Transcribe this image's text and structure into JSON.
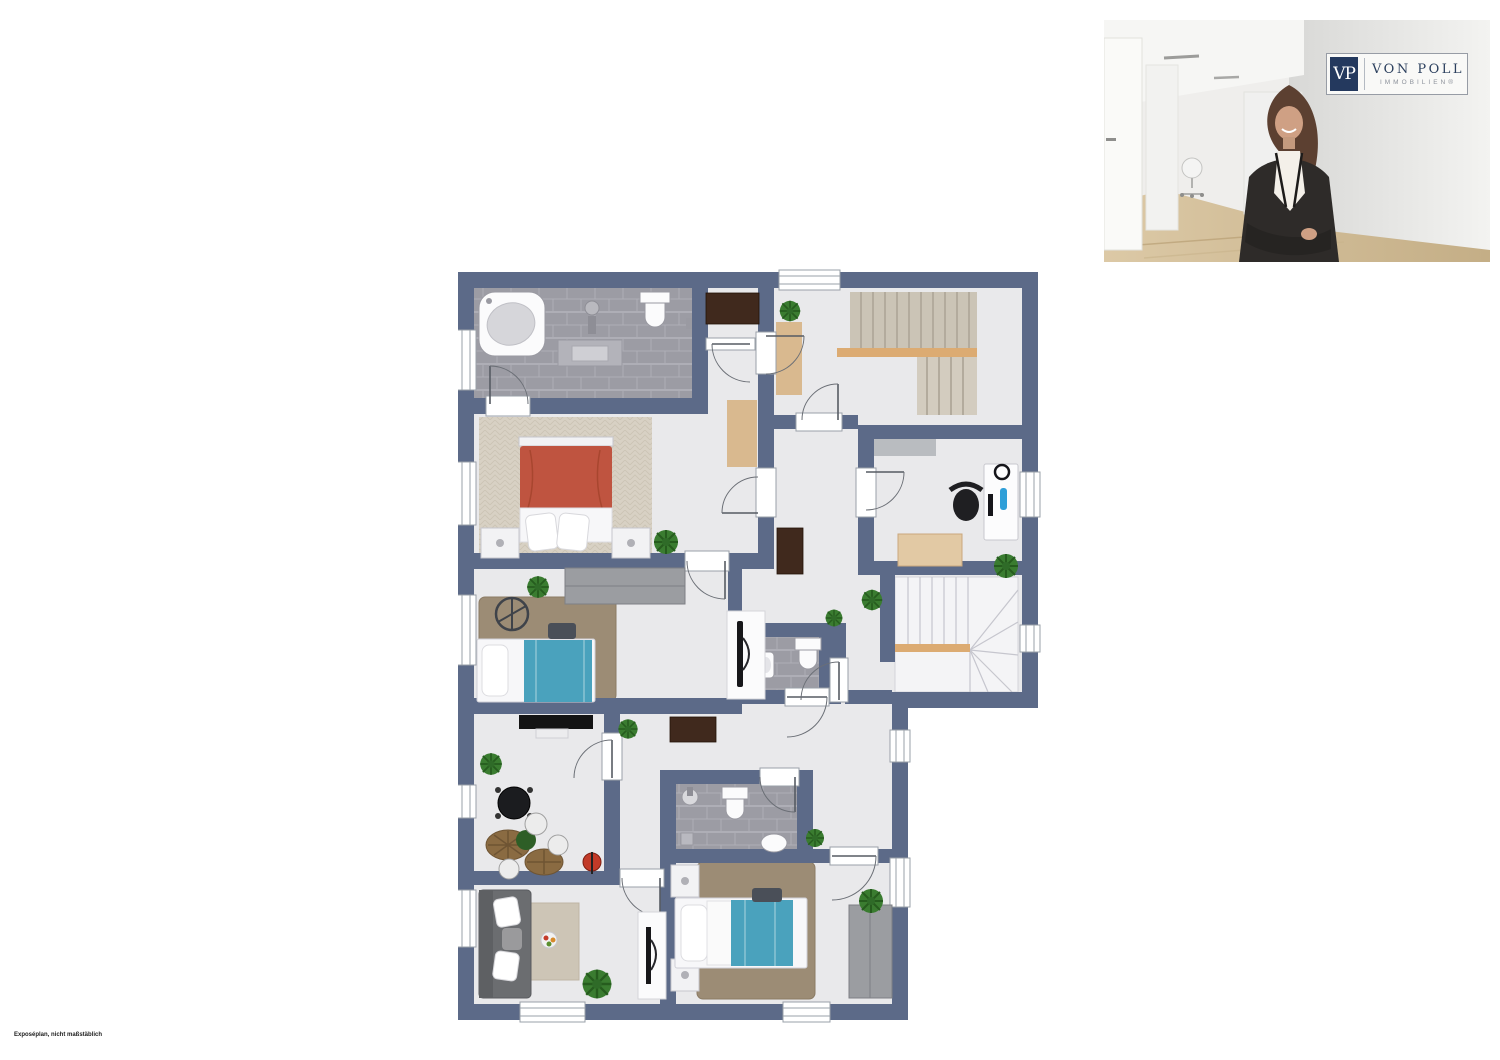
{
  "branding": {
    "logo_monogram": "VP",
    "logo_name": "VON POLL",
    "logo_subtitle": "IMMOBILIEN®"
  },
  "disclaimer": "Exposéplan, nicht maßstäblich",
  "colors": {
    "wall": "#5c6a88",
    "floor": "#e9e9eb",
    "tile": "#9c9ca4",
    "tile_line": "#aeaeb6",
    "carpet_main": "#d8d1c4",
    "rug_shag": "#9c8c75",
    "rug_light": "#cdc5b6",
    "runner": "#d9b98f",
    "stair_carpet": "#cbc4b6",
    "stair_stripe": "#b3ab9d",
    "stair_wood": "#dcab72",
    "stair_white": "#f4f4f6",
    "stair_line": "#c6c6ce",
    "bed_red": "#bf5440",
    "bed_blue": "#4aa2bd",
    "wardrobe": "#9b9da1",
    "wood_dark": "#40291d",
    "sofa": "#6b6d70",
    "plant": "#3a7c30",
    "plant_dark": "#265c1e",
    "door_arc": "#6b6f76",
    "window_stroke": "#9aa0a8",
    "fixture_white": "#fbfbfc",
    "fixture_stroke": "#9a9aa2",
    "desk_tan": "#e2c9a4",
    "office_rug": "#b9bcc0",
    "logo_navy": "#24395e",
    "logo_text": "#2c405e",
    "logo_gray": "#8d929b",
    "photo_wall": "#e3e3e1",
    "photo_floor": "#d5c29c",
    "blazer": "#2e2b29",
    "skin": "#cfa084",
    "hair": "#5c4031"
  },
  "floorplan": {
    "type": "apartment-floor-plan",
    "rooms": [
      {
        "name": "bathroom-top",
        "furniture": [
          "corner-bathtub",
          "vanity-washbasin",
          "faucet",
          "toilet",
          "tiled-floor"
        ]
      },
      {
        "name": "hallway-stairs-up",
        "furniture": [
          "staircase-up",
          "runner-rug",
          "plant"
        ]
      },
      {
        "name": "closet-vestibule",
        "furniture": [
          "dresser"
        ]
      },
      {
        "name": "bedroom-main",
        "furniture": [
          "double-bed-red",
          "nightstand",
          "nightstand",
          "runner-rug",
          "carpet",
          "plant"
        ]
      },
      {
        "name": "home-office",
        "furniture": [
          "desk",
          "office-chair",
          "monitor",
          "headphones",
          "side-table",
          "rug",
          "plant"
        ]
      },
      {
        "name": "stairwell-down",
        "furniture": [
          "winder-staircase"
        ]
      },
      {
        "name": "hallway-middle",
        "furniture": [
          "dresser",
          "plant",
          "plant"
        ]
      },
      {
        "name": "bedroom-child-1",
        "furniture": [
          "single-bed-blue",
          "wardrobe",
          "shag-rug",
          "wall-wheel-decor",
          "tv-panel",
          "plant"
        ]
      },
      {
        "name": "wc",
        "furniture": [
          "toilet",
          "washbasin",
          "tiled-floor"
        ]
      },
      {
        "name": "hallway-lower",
        "furniture": [
          "sideboard",
          "plant",
          "plant"
        ]
      },
      {
        "name": "dining-room",
        "furniture": [
          "tv-board",
          "round-table",
          "rattan-chairs",
          "wire-chairs",
          "red-stool",
          "plant"
        ]
      },
      {
        "name": "living-room",
        "furniture": [
          "corner-sofa",
          "rug",
          "fruit-bowl-table",
          "tv-panel",
          "plant"
        ]
      },
      {
        "name": "bathroom-lower",
        "furniture": [
          "washbasin",
          "toilet",
          "shower-drain",
          "washbasin",
          "tiled-floor"
        ]
      },
      {
        "name": "bedroom-child-2",
        "furniture": [
          "single-bed-blue",
          "wardrobe",
          "shag-rug",
          "nightstand",
          "nightstand",
          "plant"
        ]
      }
    ],
    "window_count": 11,
    "door_count": 13
  }
}
